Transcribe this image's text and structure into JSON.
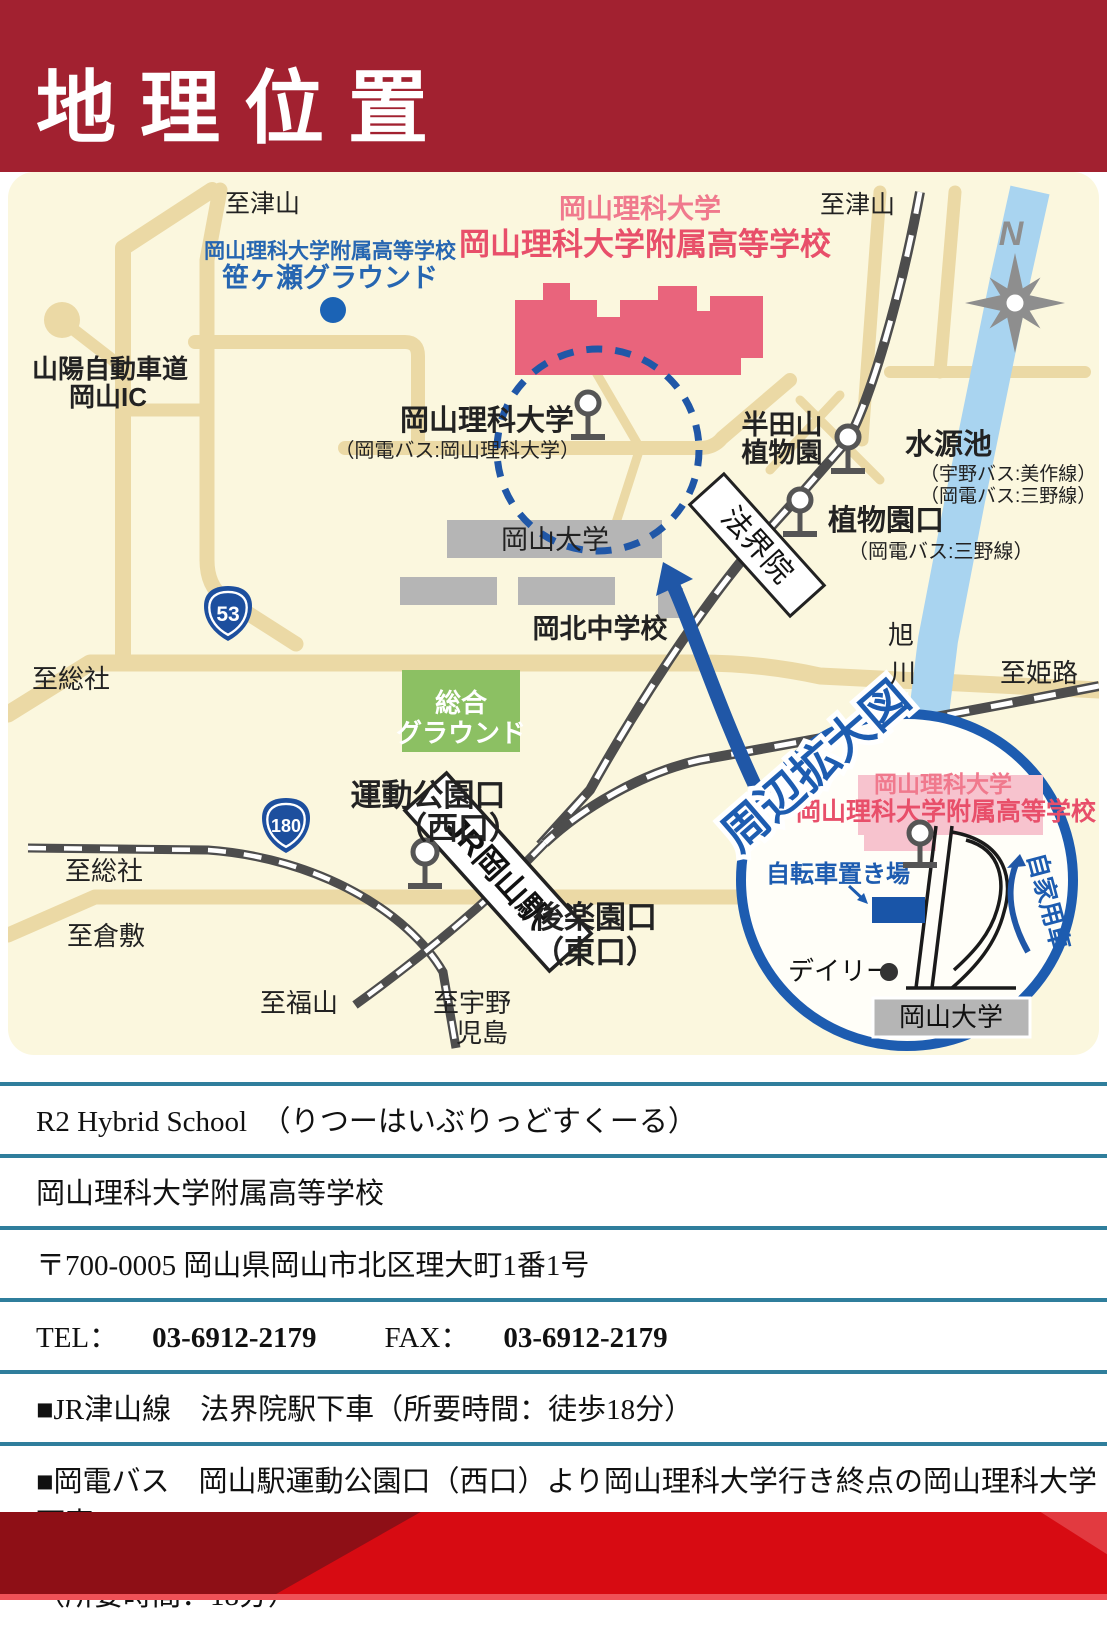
{
  "header": {
    "title": "地理位置"
  },
  "map": {
    "labels": {
      "to_tsuyama_left": "至津山",
      "to_tsuyama_right": "至津山",
      "sasagase_line1": "岡山理科大学附属高等学校",
      "sasagase_line2": "笹ヶ瀬グラウンド",
      "ridai_univ_pink": "岡山理科大学",
      "fuzoku_high_red": "岡山理科大学附属高等学校",
      "sanyo_expwy": "山陽自動車道",
      "okayama_ic": "岡山IC",
      "ridai_bus_stop": "岡山理科大学",
      "ridai_bus_note": "（岡電バス:岡山理科大学）",
      "handayama1": "半田山",
      "handayama2": "植物園",
      "suigenchi": "水源池",
      "suigenchi_note1": "（宇野バス:美作線）",
      "suigenchi_note2": "（岡電バス:三野線）",
      "shokubutsuen_guchi": "植物園口",
      "shokubutsuen_note": "（岡電バス:三野線）",
      "okayama_univ": "岡山大学",
      "kohoku_jhs": "岡北中学校",
      "to_sosha1": "至総社",
      "to_sosha2": "至総社",
      "to_kurashiki": "至倉敷",
      "to_fukuyama": "至福山",
      "to_uno": "至宇野",
      "kojima": "児島",
      "to_himeji": "至姫路",
      "sogo1": "総合",
      "sogo2": "グラウンド",
      "undo_koen_guchi": "運動公園口",
      "nishi_guchi": "（西口）",
      "korakuen_guchi": "後楽園口",
      "higashi_guchi": "（東口）",
      "asahi": "旭",
      "kawa": "川",
      "shuhen_kakudai": "周辺拡大図"
    },
    "stations": {
      "hokaiin": "法界院",
      "jr_okayama": "JR岡山駅"
    },
    "shields": {
      "r53": "53",
      "r180": "180"
    },
    "compass": {
      "n": "N"
    },
    "inset": {
      "ridai_univ": "岡山理科大学",
      "fuzoku_high": "岡山理科大学附属高等学校",
      "bicycle": "自転車置き場",
      "daily": "デイリー",
      "okayama_univ": "岡山大学",
      "private_car": "自家用車"
    },
    "colors": {
      "accent_blue": "#1D5CB0",
      "pink_building": "#E9647C",
      "red_header": "#A22130",
      "footer_red": "#D70B12",
      "teal_rule": "#2F7E9C"
    }
  },
  "info": {
    "row1": "R2 Hybrid School　（りつーはいぶりっどすくーる）",
    "row2": "岡山理科大学附属高等学校",
    "row3": "〒700-0005 岡山県岡山市北区理大町1番1号",
    "tel_label": "TEL：",
    "tel_value": "03-6912-2179",
    "fax_label": "FAX：",
    "fax_value": "03-6912-2179",
    "row5": "■JR津山線　法界院駅下車（所要時間：徒歩18分）",
    "row6": "■岡電バス　岡山駅運動公園口（西口）より岡山理科大学行き終点の岡山理科大学下車",
    "row7": "（所要時間：18分）"
  }
}
